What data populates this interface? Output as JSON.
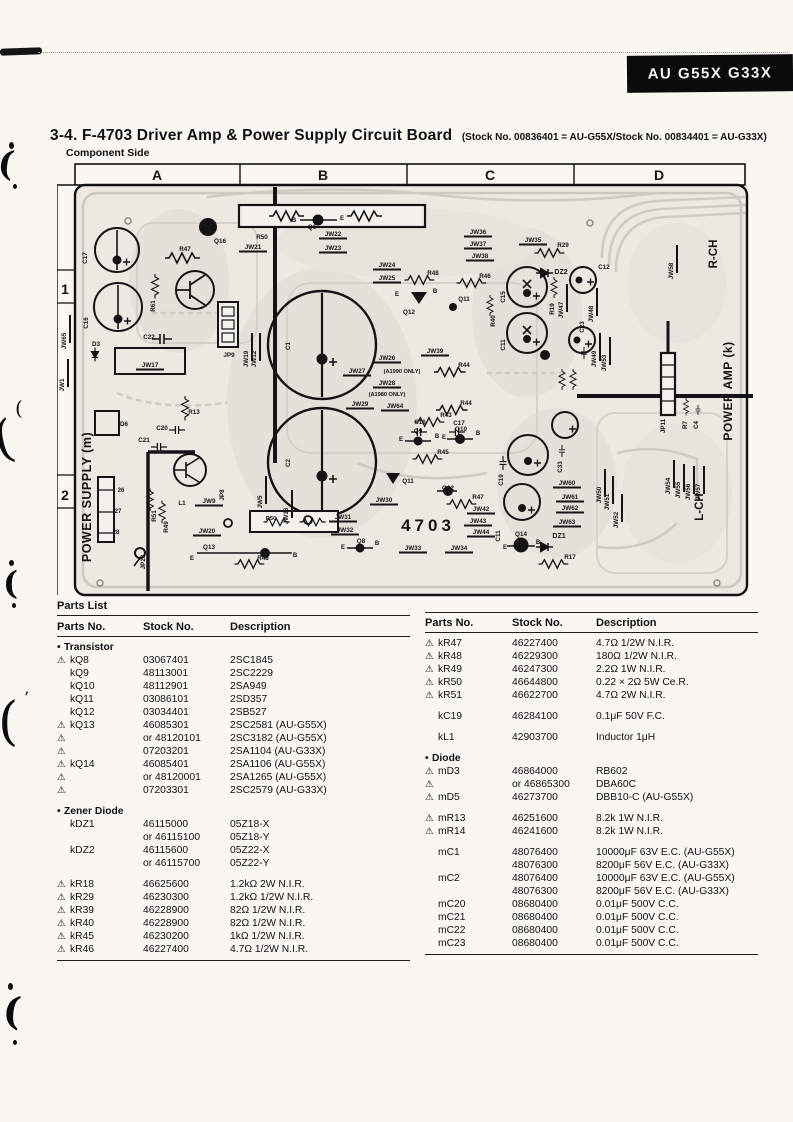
{
  "banner": {
    "model": "AU G55X G33X"
  },
  "header": {
    "section_number": "3-4.",
    "title": "F-4703 Driver Amp & Power Supply Circuit Board",
    "stock_note": "(Stock No. 00836401 = AU-G55X/Stock No. 00834401 = AU-G33X)",
    "view_label": "Component Side"
  },
  "board": {
    "grid_columns": [
      "A",
      "B",
      "C",
      "D"
    ],
    "grid_rows": [
      "1",
      "2"
    ],
    "regions": {
      "power_supply": "POWER SUPPLY (m)",
      "power_amp": "POWER AMP (k)",
      "right_channel": "R-CH",
      "left_channel": "L-CH",
      "board_number": "4703"
    },
    "labels": [
      {
        "t": "R47",
        "x": 128,
        "y": 88
      },
      {
        "t": "Q16",
        "x": 163,
        "y": 80
      },
      {
        "t": "R50",
        "x": 205,
        "y": 76
      },
      {
        "t": "JW21",
        "x": 196,
        "y": 86
      },
      {
        "t": "B",
        "x": 237,
        "y": 59,
        "s": 6
      },
      {
        "t": "Q6",
        "x": 255,
        "y": 66
      },
      {
        "t": "E",
        "x": 285,
        "y": 57,
        "s": 6
      },
      {
        "t": "JW22",
        "x": 276,
        "y": 73
      },
      {
        "t": "JW23",
        "x": 276,
        "y": 87
      },
      {
        "t": "JW24",
        "x": 330,
        "y": 104
      },
      {
        "t": "JW25",
        "x": 330,
        "y": 117
      },
      {
        "t": "JW36",
        "x": 421,
        "y": 71
      },
      {
        "t": "JW37",
        "x": 421,
        "y": 83
      },
      {
        "t": "JW38",
        "x": 423,
        "y": 95
      },
      {
        "t": "JW35",
        "x": 476,
        "y": 79
      },
      {
        "t": "R29",
        "x": 506,
        "y": 84
      },
      {
        "t": "DZ2",
        "x": 504,
        "y": 111,
        "s": 7
      },
      {
        "t": "C12",
        "x": 547,
        "y": 106
      },
      {
        "t": "R48",
        "x": 376,
        "y": 112
      },
      {
        "t": "R46",
        "x": 428,
        "y": 115
      },
      {
        "t": "JW58",
        "x": 616,
        "y": 108,
        "r": -90
      },
      {
        "t": "E",
        "x": 340,
        "y": 133,
        "s": 6
      },
      {
        "t": "B",
        "x": 378,
        "y": 130,
        "s": 6
      },
      {
        "t": "Q12",
        "x": 352,
        "y": 151
      },
      {
        "t": "Q11",
        "x": 407,
        "y": 138
      },
      {
        "t": "C15",
        "x": 448,
        "y": 134,
        "r": -90
      },
      {
        "t": "R40",
        "x": 438,
        "y": 158,
        "r": -90
      },
      {
        "t": "C11",
        "x": 448,
        "y": 182,
        "r": -90
      },
      {
        "t": "R19",
        "x": 497,
        "y": 146,
        "r": -90
      },
      {
        "t": "JW47",
        "x": 506,
        "y": 147,
        "r": -90
      },
      {
        "t": "JW48",
        "x": 536,
        "y": 151,
        "r": -90
      },
      {
        "t": "C23",
        "x": 527,
        "y": 164,
        "r": -90
      },
      {
        "t": "JW39",
        "x": 378,
        "y": 190
      },
      {
        "t": "JW49",
        "x": 539,
        "y": 196,
        "r": -90
      },
      {
        "t": "JW53",
        "x": 549,
        "y": 200,
        "r": -90
      },
      {
        "t": "JW26",
        "x": 330,
        "y": 197
      },
      {
        "t": "JW27",
        "x": 300,
        "y": 210
      },
      {
        "t": "(A1990 ONLY)",
        "x": 345,
        "y": 210,
        "s": 5.6
      },
      {
        "t": "JW28",
        "x": 330,
        "y": 222
      },
      {
        "t": "(A1980 ONLY)",
        "x": 330,
        "y": 233,
        "s": 5.6
      },
      {
        "t": "JW29",
        "x": 303,
        "y": 243
      },
      {
        "t": "JW64",
        "x": 338,
        "y": 245
      },
      {
        "t": "R44",
        "x": 407,
        "y": 204
      },
      {
        "t": "R44",
        "x": 409,
        "y": 242
      },
      {
        "t": "R43",
        "x": 389,
        "y": 254
      },
      {
        "t": "C16",
        "x": 363,
        "y": 261
      },
      {
        "t": "C17",
        "x": 402,
        "y": 262
      },
      {
        "t": "E",
        "x": 344,
        "y": 278,
        "s": 6
      },
      {
        "t": "Q9",
        "x": 361,
        "y": 270
      },
      {
        "t": "B",
        "x": 380,
        "y": 275,
        "s": 6
      },
      {
        "t": "E",
        "x": 387,
        "y": 276,
        "s": 6
      },
      {
        "t": "Q10",
        "x": 404,
        "y": 268
      },
      {
        "t": "B",
        "x": 421,
        "y": 272,
        "s": 6
      },
      {
        "t": "R45",
        "x": 386,
        "y": 291
      },
      {
        "t": "C17",
        "x": 30,
        "y": 95,
        "r": -90
      },
      {
        "t": "C16",
        "x": 31,
        "y": 160,
        "r": -90
      },
      {
        "t": "JW65",
        "x": 9,
        "y": 178,
        "r": -90
      },
      {
        "t": "JW1",
        "x": 7,
        "y": 222,
        "r": -90
      },
      {
        "t": "R61",
        "x": 98,
        "y": 143,
        "r": -90
      },
      {
        "t": "C22",
        "x": 92,
        "y": 176
      },
      {
        "t": "D3",
        "x": 39,
        "y": 183
      },
      {
        "t": "JW17",
        "x": 93,
        "y": 204
      },
      {
        "t": "JP9",
        "x": 172,
        "y": 194
      },
      {
        "t": "JW19",
        "x": 191,
        "y": 196,
        "r": -90
      },
      {
        "t": "JW12",
        "x": 199,
        "y": 196,
        "r": -90
      },
      {
        "t": "R13",
        "x": 137,
        "y": 251
      },
      {
        "t": "D6",
        "x": 67,
        "y": 263
      },
      {
        "t": "C20",
        "x": 105,
        "y": 267
      },
      {
        "t": "C21",
        "x": 87,
        "y": 279
      },
      {
        "t": "C1",
        "x": 233,
        "y": 183,
        "r": -90
      },
      {
        "t": "C2",
        "x": 233,
        "y": 300,
        "r": -90
      },
      {
        "t": "L1",
        "x": 125,
        "y": 342
      },
      {
        "t": "R51",
        "x": 99,
        "y": 353,
        "r": -90
      },
      {
        "t": "R49",
        "x": 111,
        "y": 364,
        "r": -90
      },
      {
        "t": "JW9",
        "x": 152,
        "y": 340
      },
      {
        "t": "JP8",
        "x": 167,
        "y": 332,
        "r": -90
      },
      {
        "t": "JW5",
        "x": 205,
        "y": 339,
        "r": -90
      },
      {
        "t": "JW16",
        "x": 231,
        "y": 353,
        "r": -90
      },
      {
        "t": "26",
        "x": 64,
        "y": 329,
        "s": 6
      },
      {
        "t": "27",
        "x": 61,
        "y": 350,
        "s": 6
      },
      {
        "t": "28",
        "x": 59,
        "y": 371,
        "s": 6
      },
      {
        "t": "JP23",
        "x": 88,
        "y": 399,
        "r": -90
      },
      {
        "t": "JW20",
        "x": 150,
        "y": 370
      },
      {
        "t": "Q13",
        "x": 152,
        "y": 386
      },
      {
        "t": "E",
        "x": 135,
        "y": 397,
        "s": 6
      },
      {
        "t": "B",
        "x": 238,
        "y": 394,
        "s": 6
      },
      {
        "t": "R50",
        "x": 214,
        "y": 357,
        "s": 5.8
      },
      {
        "t": "R48",
        "x": 206,
        "y": 397
      },
      {
        "t": "JW30",
        "x": 327,
        "y": 339
      },
      {
        "t": "JW31",
        "x": 286,
        "y": 356
      },
      {
        "t": "JW32",
        "x": 288,
        "y": 369
      },
      {
        "t": "E",
        "x": 286,
        "y": 386,
        "s": 6
      },
      {
        "t": "Q8",
        "x": 304,
        "y": 380
      },
      {
        "t": "B",
        "x": 320,
        "y": 382,
        "s": 6
      },
      {
        "t": "JW33",
        "x": 356,
        "y": 387
      },
      {
        "t": "JW34",
        "x": 402,
        "y": 387
      },
      {
        "t": "Q11",
        "x": 351,
        "y": 320
      },
      {
        "t": "Q12",
        "x": 391,
        "y": 327
      },
      {
        "t": "R47",
        "x": 421,
        "y": 336
      },
      {
        "t": "JW42",
        "x": 424,
        "y": 348
      },
      {
        "t": "JW43",
        "x": 421,
        "y": 360
      },
      {
        "t": "JW44",
        "x": 424,
        "y": 371
      },
      {
        "t": "C19",
        "x": 446,
        "y": 317,
        "r": -90
      },
      {
        "t": "C11",
        "x": 443,
        "y": 373,
        "r": -90
      },
      {
        "t": "E",
        "x": 448,
        "y": 386,
        "s": 6
      },
      {
        "t": "Q14",
        "x": 464,
        "y": 373
      },
      {
        "t": "B",
        "x": 481,
        "y": 381,
        "s": 6
      },
      {
        "t": "DZ1",
        "x": 502,
        "y": 375,
        "s": 7
      },
      {
        "t": "R17",
        "x": 513,
        "y": 396
      },
      {
        "t": "C33",
        "x": 505,
        "y": 304,
        "r": -90
      },
      {
        "t": "JW60",
        "x": 510,
        "y": 322
      },
      {
        "t": "JW61",
        "x": 513,
        "y": 336
      },
      {
        "t": "JW62",
        "x": 513,
        "y": 347
      },
      {
        "t": "JW63",
        "x": 510,
        "y": 361
      },
      {
        "t": "JW50",
        "x": 544,
        "y": 332,
        "r": -90
      },
      {
        "t": "JW51",
        "x": 552,
        "y": 339,
        "r": -90
      },
      {
        "t": "JW52",
        "x": 561,
        "y": 357,
        "r": -90
      },
      {
        "t": "JP11",
        "x": 608,
        "y": 263,
        "r": -90
      },
      {
        "t": "R7",
        "x": 630,
        "y": 262,
        "r": -90
      },
      {
        "t": "C4",
        "x": 641,
        "y": 262,
        "r": -90
      },
      {
        "t": "JW54",
        "x": 613,
        "y": 323,
        "r": -90
      },
      {
        "t": "JW55",
        "x": 623,
        "y": 327,
        "r": -90
      },
      {
        "t": "JW56",
        "x": 633,
        "y": 329,
        "r": -90
      },
      {
        "t": "JW57",
        "x": 643,
        "y": 329,
        "r": -90
      }
    ]
  },
  "parts_list": {
    "heading": "Parts List",
    "columns": [
      "Parts No.",
      "Stock No.",
      "Description"
    ],
    "left": [
      {
        "section": "Transistor"
      },
      {
        "warn": 1,
        "part": "kQ8",
        "stock": "03067401",
        "desc": "2SC1845"
      },
      {
        "part": "kQ9",
        "stock": "48113001",
        "desc": "2SC2229"
      },
      {
        "part": "kQ10",
        "stock": "48112901",
        "desc": "2SA949"
      },
      {
        "part": "kQ11",
        "stock": "03086101",
        "desc": "2SD357"
      },
      {
        "part": "kQ12",
        "stock": "03034401",
        "desc": "2SB527"
      },
      {
        "warn": 1,
        "part": "kQ13",
        "stock": "46085301",
        "desc": "2SC2581 (AU-G55X)"
      },
      {
        "warn": 1,
        "part": "",
        "stock": "or 48120101",
        "desc": "2SC3182 (AU-G55X)"
      },
      {
        "warn": 1,
        "part": "",
        "stock": "07203201",
        "desc": "2SA1104 (AU-G33X)"
      },
      {
        "warn": 1,
        "part": "kQ14",
        "stock": "46085401",
        "desc": "2SA1106 (AU-G55X)"
      },
      {
        "warn": 1,
        "part": "",
        "stock": "or 48120001",
        "desc": "2SA1265 (AU-G55X)"
      },
      {
        "warn": 1,
        "part": "",
        "stock": "07203301",
        "desc": "2SC2579 (AU-G33X)"
      },
      {
        "section": "Zener Diode",
        "gap": 1
      },
      {
        "part": "kDZ1",
        "stock": "46115000",
        "desc": "05Z18-X"
      },
      {
        "part": "",
        "stock": "or 46115100",
        "desc": "05Z18-Y"
      },
      {
        "part": "kDZ2",
        "stock": "46115600",
        "desc": "05Z22-X"
      },
      {
        "part": "",
        "stock": "or 46115700",
        "desc": "05Z22-Y"
      },
      {
        "warn": 1,
        "part": "kR18",
        "stock": "46625600",
        "desc": "1.2kΩ 2W N.I.R.",
        "gap": 1
      },
      {
        "warn": 1,
        "part": "kR29",
        "stock": "46230300",
        "desc": "1.2kΩ 1/2W N.I.R."
      },
      {
        "warn": 1,
        "part": "kR39",
        "stock": "46228900",
        "desc": "82Ω 1/2W N.I.R."
      },
      {
        "warn": 1,
        "part": "kR40",
        "stock": "46228900",
        "desc": "82Ω 1/2W N.I.R."
      },
      {
        "warn": 1,
        "part": "kR45",
        "stock": "46230200",
        "desc": "1kΩ 1/2W N.I.R."
      },
      {
        "warn": 1,
        "part": "kR46",
        "stock": "46227400",
        "desc": "4.7Ω 1/2W N.I.R."
      }
    ],
    "right": [
      {
        "warn": 1,
        "part": "kR47",
        "stock": "46227400",
        "desc": "4.7Ω 1/2W N.I.R."
      },
      {
        "warn": 1,
        "part": "kR48",
        "stock": "46229300",
        "desc": "180Ω 1/2W N.I.R."
      },
      {
        "warn": 1,
        "part": "kR49",
        "stock": "46247300",
        "desc": "2.2Ω 1W N.I.R."
      },
      {
        "warn": 1,
        "part": "kR50",
        "stock": "46644800",
        "desc": "0.22 × 2Ω 5W Ce.R."
      },
      {
        "warn": 1,
        "part": "kR51",
        "stock": "46622700",
        "desc": "4.7Ω 2W N.I.R."
      },
      {
        "part": "kC19",
        "stock": "46284100",
        "desc": "0.1μF 50V F.C.",
        "gap": 1
      },
      {
        "part": "kL1",
        "stock": "42903700",
        "desc": "Inductor 1μH",
        "gap": 1
      },
      {
        "section": "Diode",
        "gap": 1
      },
      {
        "warn": 1,
        "part": "mD3",
        "stock": "46864000",
        "desc": "RB602"
      },
      {
        "warn": 1,
        "part": "",
        "stock": "or 46865300",
        "desc": "DBA60C"
      },
      {
        "warn": 1,
        "part": "mD5",
        "stock": "46273700",
        "desc": "DBB10-C (AU-G55X)"
      },
      {
        "warn": 1,
        "part": "mR13",
        "stock": "46251600",
        "desc": "8.2k 1W N.I.R.",
        "gap": 1
      },
      {
        "warn": 1,
        "part": "mR14",
        "stock": "46241600",
        "desc": "8.2k 1W N.I.R."
      },
      {
        "part": "mC1",
        "stock": "48076400",
        "desc": "10000μF 63V E.C. (AU-G55X)",
        "gap": 1
      },
      {
        "part": "",
        "stock": "48076300",
        "desc": "8200μF 56V E.C. (AU-G33X)"
      },
      {
        "part": "mC2",
        "stock": "48076400",
        "desc": "10000μF 63V E.C. (AU-G55X)"
      },
      {
        "part": "",
        "stock": "48076300",
        "desc": "8200μF 56V E.C. (AU-G33X)"
      },
      {
        "part": "mC20",
        "stock": "08680400",
        "desc": "0.01μF 500V C.C."
      },
      {
        "part": "mC21",
        "stock": "08680400",
        "desc": "0.01μF 500V C.C."
      },
      {
        "part": "mC22",
        "stock": "08680400",
        "desc": "0.01μF 500V C.C."
      },
      {
        "part": "mC23",
        "stock": "08680400",
        "desc": "0.01μF 500V C.C."
      }
    ]
  }
}
